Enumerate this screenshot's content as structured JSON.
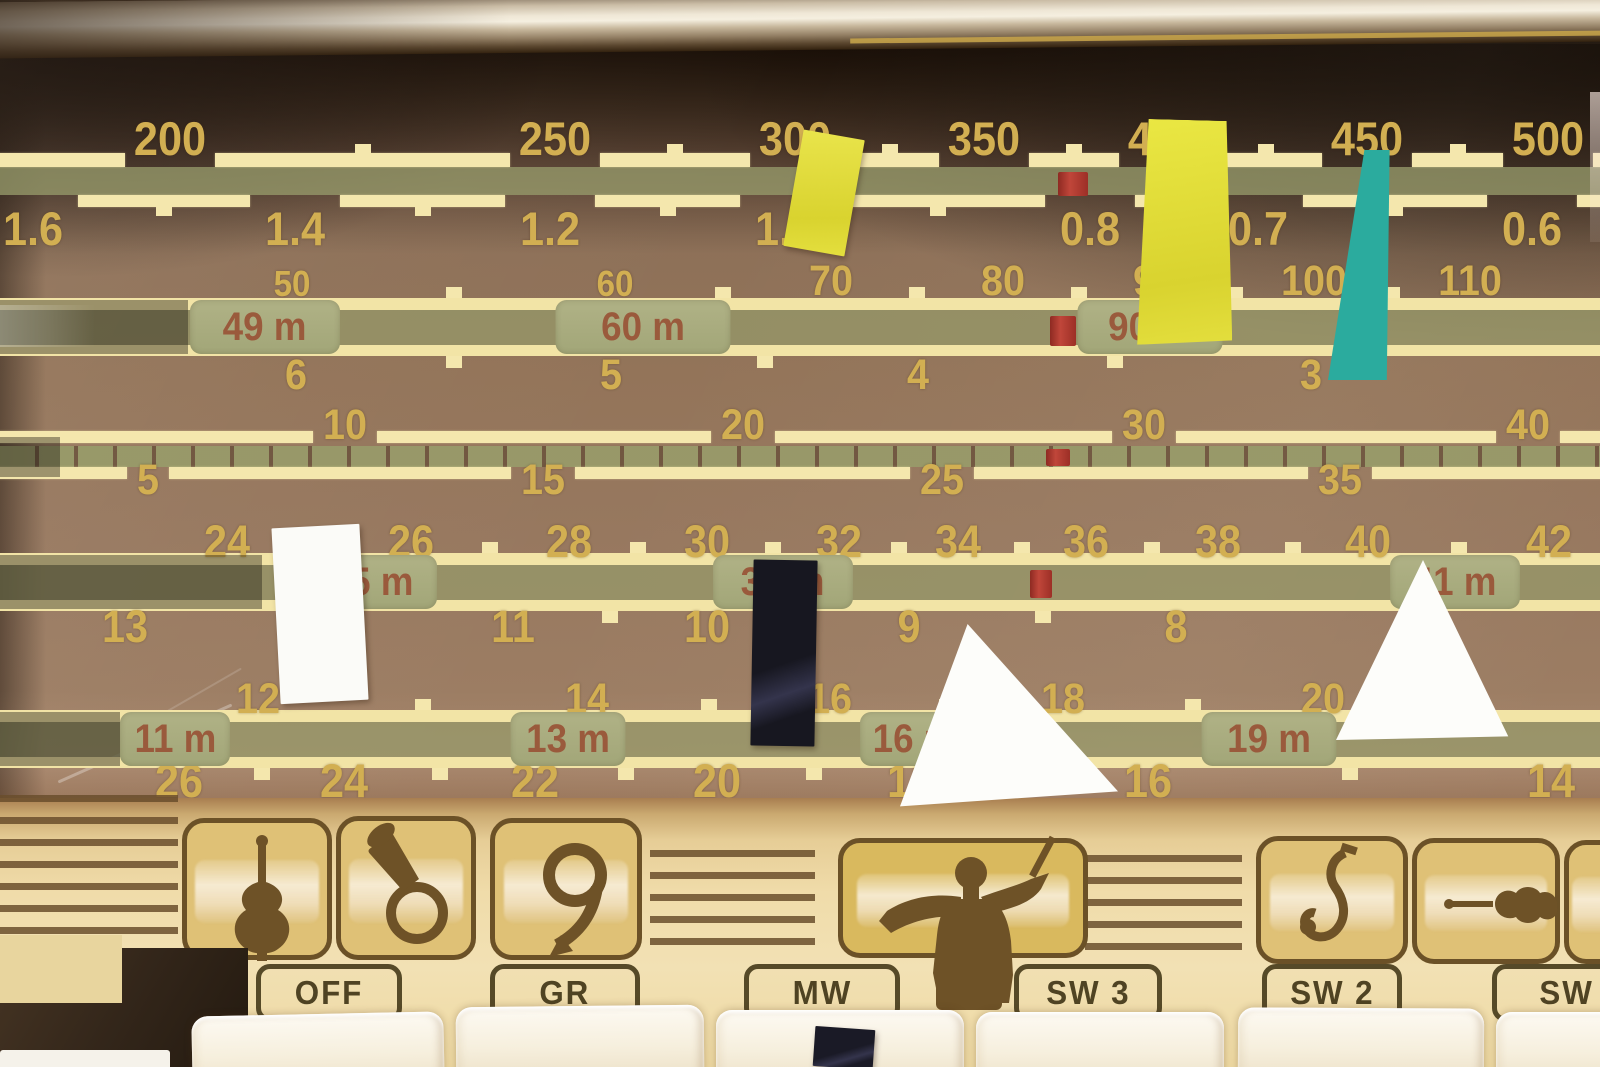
{
  "colors": {
    "dial_brown": "#8d7158",
    "scale_line": "#f4e7ad",
    "number_gold": "#d2af52",
    "band_green": "#969a6a",
    "badge_text": "#9a5a3c",
    "pointer_red": "#b23a2e",
    "panel_cream": "#f0dcaa",
    "icon_dark": "#6e5227",
    "sticker_yellow": "#e9e44b",
    "sticker_teal": "#2bab9e",
    "sticker_white": "#fbfbf8",
    "sticker_navy": "#171720"
  },
  "dial": {
    "scales": [
      {
        "id": "mw-meters",
        "style": "line",
        "top": 153,
        "bottom": 167,
        "tick": "up",
        "side": "above",
        "label_y": 120,
        "size": 47,
        "labels": [
          [
            "200",
            170
          ],
          [
            "250",
            555
          ],
          [
            "300",
            795
          ],
          [
            "350",
            984
          ],
          [
            "400",
            1164
          ],
          [
            "450",
            1367
          ],
          [
            "500",
            1548
          ]
        ]
      },
      {
        "id": "mw-mhz",
        "style": "line",
        "top": 195,
        "bottom": 207,
        "tick": "down",
        "side": "below",
        "label_y": 210,
        "size": 47,
        "labels": [
          [
            "1.6",
            33
          ],
          [
            "1.4",
            295
          ],
          [
            "1.2",
            550
          ],
          [
            "1.0",
            785
          ],
          [
            "0.8",
            1090
          ],
          [
            "0.7",
            1258
          ],
          [
            "0.6",
            1532
          ]
        ]
      },
      {
        "id": "sw-90m-band",
        "style": "band",
        "top": 298,
        "bottom": 356,
        "above_y": 264,
        "above_size": 43,
        "below_y": 358,
        "below_size": 43,
        "labels_above": [
          [
            "50",
            292,
            36
          ],
          [
            "60",
            615,
            36
          ],
          [
            "70",
            831
          ],
          [
            "80",
            1003
          ],
          [
            "90",
            1155
          ],
          [
            "100",
            1314
          ],
          [
            "110",
            1470
          ]
        ],
        "labels_below": [
          [
            "6",
            296
          ],
          [
            "5",
            611
          ],
          [
            "4",
            918
          ],
          [
            "3",
            1311
          ]
        ],
        "badges": [
          [
            "49 m",
            265,
            150
          ],
          [
            "60 m",
            643,
            175
          ],
          [
            "90 m",
            1150,
            145
          ]
        ]
      },
      {
        "id": "logging-scale",
        "style": "segmented",
        "top": 431,
        "bottom": 479,
        "above_y": 408,
        "above_size": 43,
        "below_y": 463,
        "below_size": 43,
        "labels_above": [
          [
            "10",
            345
          ],
          [
            "20",
            743
          ],
          [
            "30",
            1144
          ],
          [
            "40",
            1528
          ]
        ],
        "labels_below": [
          [
            "5",
            148
          ],
          [
            "15",
            543
          ],
          [
            "25",
            942
          ],
          [
            "35",
            1340
          ]
        ]
      },
      {
        "id": "sw-31m-band",
        "style": "band",
        "top": 553,
        "bottom": 611,
        "above_y": 524,
        "above_size": 45,
        "below_y": 609,
        "below_size": 45,
        "labels_above": [
          [
            "24",
            227
          ],
          [
            "26",
            411
          ],
          [
            "28",
            569
          ],
          [
            "30",
            707
          ],
          [
            "32",
            839
          ],
          [
            "34",
            958
          ],
          [
            "36",
            1086
          ],
          [
            "38",
            1218
          ],
          [
            "40",
            1368
          ],
          [
            "42",
            1549
          ]
        ],
        "labels_below": [
          [
            "13",
            125
          ],
          [
            "11",
            513
          ],
          [
            "10",
            707
          ],
          [
            "9",
            909
          ],
          [
            "8",
            1176
          ]
        ],
        "badges": [
          [
            "25 m",
            372,
            130
          ],
          [
            "31 m",
            783,
            140
          ],
          [
            "41 m",
            1455,
            130
          ]
        ]
      },
      {
        "id": "sw-13m-band",
        "style": "band",
        "top": 710,
        "bottom": 768,
        "above_y": 682,
        "above_size": 43,
        "below_y": 762,
        "below_size": 47,
        "labels_above": [
          [
            "12",
            258
          ],
          [
            "14",
            587
          ],
          [
            "16",
            830
          ],
          [
            "18",
            1063
          ],
          [
            "20",
            1323
          ]
        ],
        "labels_below": [
          [
            "26",
            179
          ],
          [
            "24",
            344
          ],
          [
            "22",
            535
          ],
          [
            "20",
            717
          ],
          [
            "18",
            911
          ],
          [
            "16",
            1148
          ],
          [
            "14",
            1551
          ]
        ],
        "badges": [
          [
            "11 m",
            175,
            110
          ],
          [
            "13 m",
            568,
            115
          ],
          [
            "16 m",
            915,
            110
          ],
          [
            "19 m",
            1269,
            135
          ]
        ]
      }
    ],
    "red_marks": [
      {
        "x": 1058,
        "y": 172,
        "w": 30,
        "h": 24
      },
      {
        "x": 1050,
        "y": 316,
        "w": 26,
        "h": 30
      },
      {
        "x": 1046,
        "y": 449,
        "w": 24,
        "h": 17
      },
      {
        "x": 1030,
        "y": 570,
        "w": 22,
        "h": 28
      }
    ]
  },
  "stickers": [
    {
      "name": "tape-yellow-small",
      "color": "#e9e44b",
      "x": 793,
      "y": 134,
      "w": 62,
      "h": 118,
      "rotate": 10,
      "shape": "rect"
    },
    {
      "name": "tape-yellow-large",
      "color": "#eae743",
      "x": 1140,
      "y": 120,
      "w": 95,
      "h": 226,
      "rotate": 1.5,
      "shape": "trapezoid"
    },
    {
      "name": "tape-teal",
      "color": "#2bab9e",
      "x": 1328,
      "y": 150,
      "w": 70,
      "h": 230,
      "rotate": 0,
      "shape": "taper"
    },
    {
      "name": "tape-white-quad",
      "color": "#fbfbf8",
      "x": 276,
      "y": 526,
      "w": 88,
      "h": 176,
      "rotate": -3,
      "shape": "rect"
    },
    {
      "name": "tape-navy",
      "color": "#171720",
      "x": 752,
      "y": 560,
      "w": 64,
      "h": 186,
      "rotate": 1,
      "shape": "rect"
    },
    {
      "name": "tape-white-triangle-mid",
      "color": "#fdfdfa",
      "x": 900,
      "y": 624,
      "w": 218,
      "h": 188,
      "rotate": 0,
      "shape": "triangle"
    },
    {
      "name": "tape-white-triangle-right",
      "color": "#fdfdfa",
      "x": 1336,
      "y": 560,
      "w": 174,
      "h": 180,
      "rotate": 0,
      "shape": "triangle2"
    },
    {
      "name": "tape-navy-small",
      "color": "#1a1a26",
      "x": 814,
      "y": 1028,
      "w": 60,
      "h": 40,
      "rotate": 4,
      "shape": "rect"
    }
  ],
  "panel": {
    "buttons": [
      {
        "label": "OFF",
        "x": 256,
        "w": 146
      },
      {
        "label": "GR",
        "x": 490,
        "w": 150
      },
      {
        "label": "MW",
        "x": 744,
        "w": 156
      },
      {
        "label": "SW 3",
        "x": 1014,
        "w": 148
      },
      {
        "label": "SW 2",
        "x": 1262,
        "w": 140
      },
      {
        "label": "SW",
        "x": 1492,
        "w": 150
      }
    ],
    "tiles": [
      {
        "icon": "double-bass-icon",
        "x": 182,
        "y": 818,
        "w": 150,
        "h": 142
      },
      {
        "icon": "tuba-icon",
        "x": 336,
        "y": 816,
        "w": 140,
        "h": 144
      },
      {
        "icon": "horn-icon",
        "x": 490,
        "y": 818,
        "w": 152,
        "h": 142
      },
      {
        "icon": "conductor-icon",
        "x": 838,
        "y": 838,
        "w": 250,
        "h": 120
      },
      {
        "icon": "saxophone-icon",
        "x": 1256,
        "y": 836,
        "w": 152,
        "h": 128
      },
      {
        "icon": "violin-icon",
        "x": 1412,
        "y": 838,
        "w": 148,
        "h": 126
      },
      {
        "icon": "blank-icon",
        "x": 1564,
        "y": 840,
        "w": 60,
        "h": 124
      }
    ],
    "stripe_zones": [
      {
        "x": 0,
        "y": 795,
        "w": 178,
        "h": 163
      },
      {
        "x": 650,
        "y": 850,
        "w": 165,
        "h": 100
      },
      {
        "x": 1085,
        "y": 855,
        "w": 157,
        "h": 95
      }
    ],
    "keys": [
      {
        "x": 192,
        "w": 252,
        "top": 1014,
        "r": -1.2
      },
      {
        "x": 456,
        "w": 248,
        "top": 1006,
        "r": -0.6
      },
      {
        "x": 716,
        "w": 248,
        "top": 1010,
        "r": 0
      },
      {
        "x": 976,
        "w": 248,
        "top": 1012,
        "r": 0
      },
      {
        "x": 1238,
        "w": 246,
        "top": 1008,
        "r": 0.3
      },
      {
        "x": 1496,
        "w": 140,
        "top": 1012,
        "r": 0
      }
    ]
  }
}
